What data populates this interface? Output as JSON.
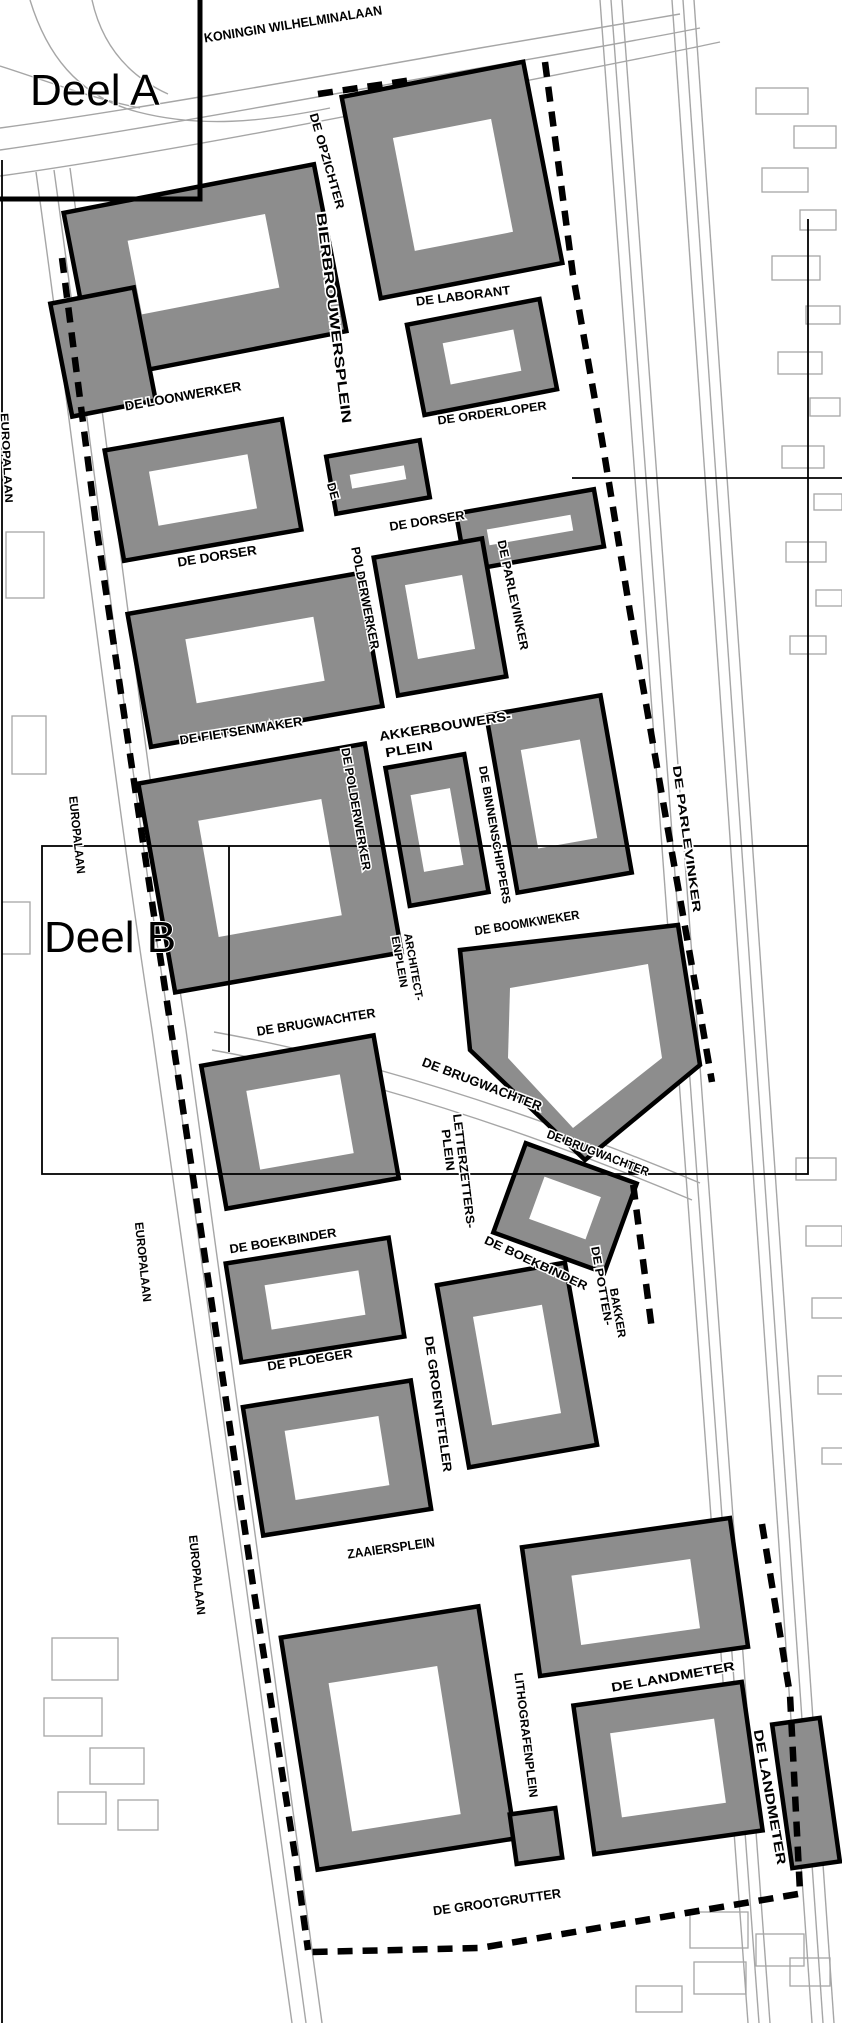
{
  "map": {
    "area_labels": {
      "deel_a": "Deel A",
      "deel_b": "Deel B"
    },
    "labels": {
      "koningin_wilhelminalaan": "KONINGIN WILHELMINALAAN",
      "europalaan": "EUROPALAAN",
      "de_opzichter": "DE OPZICHTER",
      "de_laborant": "DE LABORANT",
      "bierbrouwersplein": "BIERBROUWERSPLEIN",
      "de_loonwerker": "DE LOONWERKER",
      "de_orderloper": "DE ORDERLOPER",
      "de_prefix": "DE",
      "polderwerker": "POLDERWERKER",
      "de_polderwerker": "DE POLDERWERKER",
      "de_dorser": "DE DORSER",
      "de_parlevinker": "DE PARLEVINKER",
      "de_fietsenmaker": "DE FIETSENMAKER",
      "akkerbouwersplein_line1": "AKKERBOUWERS-",
      "plein": "PLEIN",
      "de_binnenschippers": "DE BINNENSCHIPPERS",
      "de_boomkweker": "DE BOOMKWEKER",
      "architectenplein_line1": "ARCHITECT-",
      "architectenplein_line2": "ENPLEIN",
      "de_brugwachter": "DE BRUGWACHTER",
      "letterzettersplein_line1": "LETTERZETTERS-",
      "de_boekbinder": "DE BOEKBINDER",
      "de_pottenbakker_line1": "DE POTTEN-",
      "de_pottenbakker_line2": "BAKKER",
      "de_ploeger": "DE PLOEGER",
      "de_groenteteler": "DE GROENTETELER",
      "zaaiersplein": "ZAAIERSPLEIN",
      "de_landmeter": "DE LANDMETER",
      "lithografenplein": "LITHOGRAFENPLEIN",
      "de_grootgrutter": "DE GROOTGRUTTER"
    },
    "palette": {
      "paper": "#ffffff",
      "ink": "#000000",
      "building_gray": "#8d8d8d",
      "context_line_gray": "#a6a6a6"
    }
  }
}
